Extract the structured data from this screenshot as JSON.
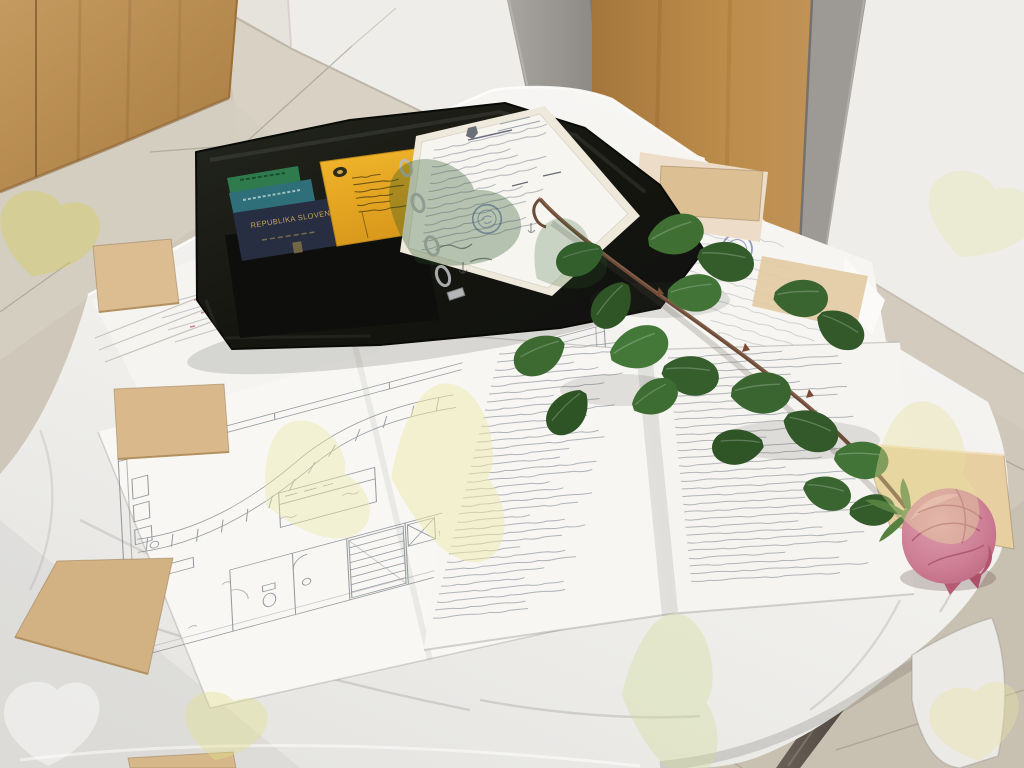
{
  "scene": {
    "type": "photograph",
    "description": "A long-stemmed pink rose lies across paperwork on a white-draped table: an open black zip document case holding passports and a yellow booklet, a ring binder with a stamped certificate, a large hand-drawn floor plan, and a folded sheet covered in a handwritten two-column list, weighted down by small plywood squares; behind are a wooden cabinet, a grey door frame with wooden door, white walls and a beige tiled floor.",
    "legible_text": {
      "navy_passport_cover": "REPUBLIKA SLOVENIJA"
    },
    "counts": {
      "passports": 3,
      "plywood_boards": 6,
      "binder_rings": 4,
      "round_stamps": 2,
      "watermark_leaves": 9
    },
    "palette": {
      "wall": "#efedea",
      "wall_shaded": "#e6e3dd",
      "floor": "#cfc8ba",
      "floor_light": "#d8d2c5",
      "floor_dark": "#c6bfb0",
      "grout": "#a89f8f",
      "cabinet_wood": "#b98a4e",
      "door_wood": "#b5813f",
      "door_frame_grey": "#9b9894",
      "tablecloth": "#f2f1ee",
      "paper": "#f7f6f3",
      "plan_ink": "#878c92",
      "handwriting_ink": "#858b95",
      "document_case_black": "#1c1d1a",
      "passport_navy": "#272e41",
      "passport_teal": "#2e6f79",
      "booklet_green": "#2f7b4e",
      "booklet_yellow": "#ecae24",
      "stamp_blue": "#4253a8",
      "rose_pink": "#cd7f95",
      "rose_deep": "#a8506c",
      "leaf_green": "#3a6530",
      "stem_brown": "#6b4a37",
      "plywood_tan": "#d9b98c",
      "table_leg_grey": "#5f584e",
      "watermark_yellow": "#e2de82",
      "watermark_green": "#2e5a2e"
    }
  }
}
